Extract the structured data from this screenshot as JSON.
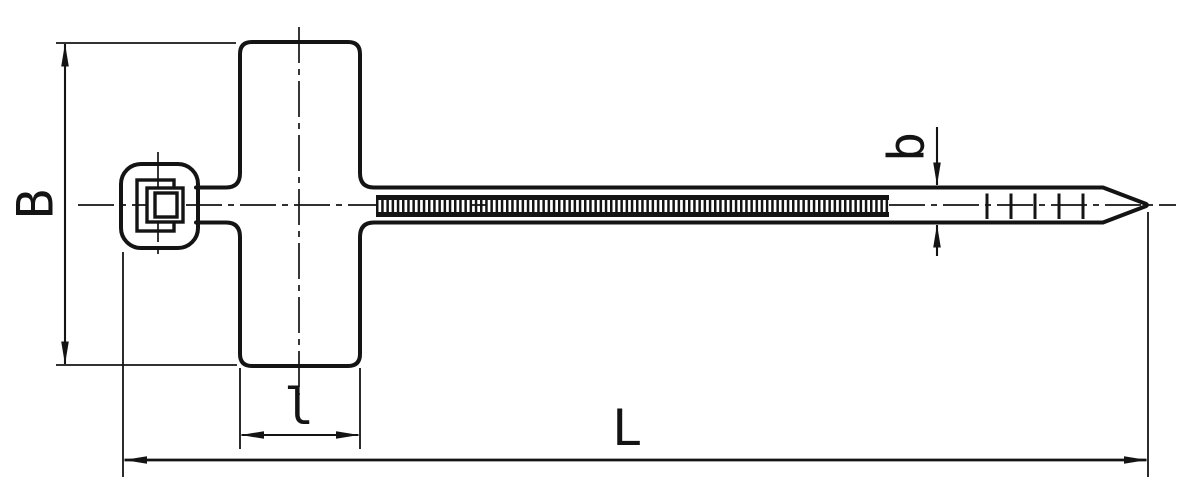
{
  "page": {
    "background": "#ffffff"
  },
  "drawing": {
    "line_color": "#141414",
    "labels": {
      "plate_height": "B",
      "plate_width": "l",
      "overall_length": "L",
      "strap_width": "b"
    }
  }
}
